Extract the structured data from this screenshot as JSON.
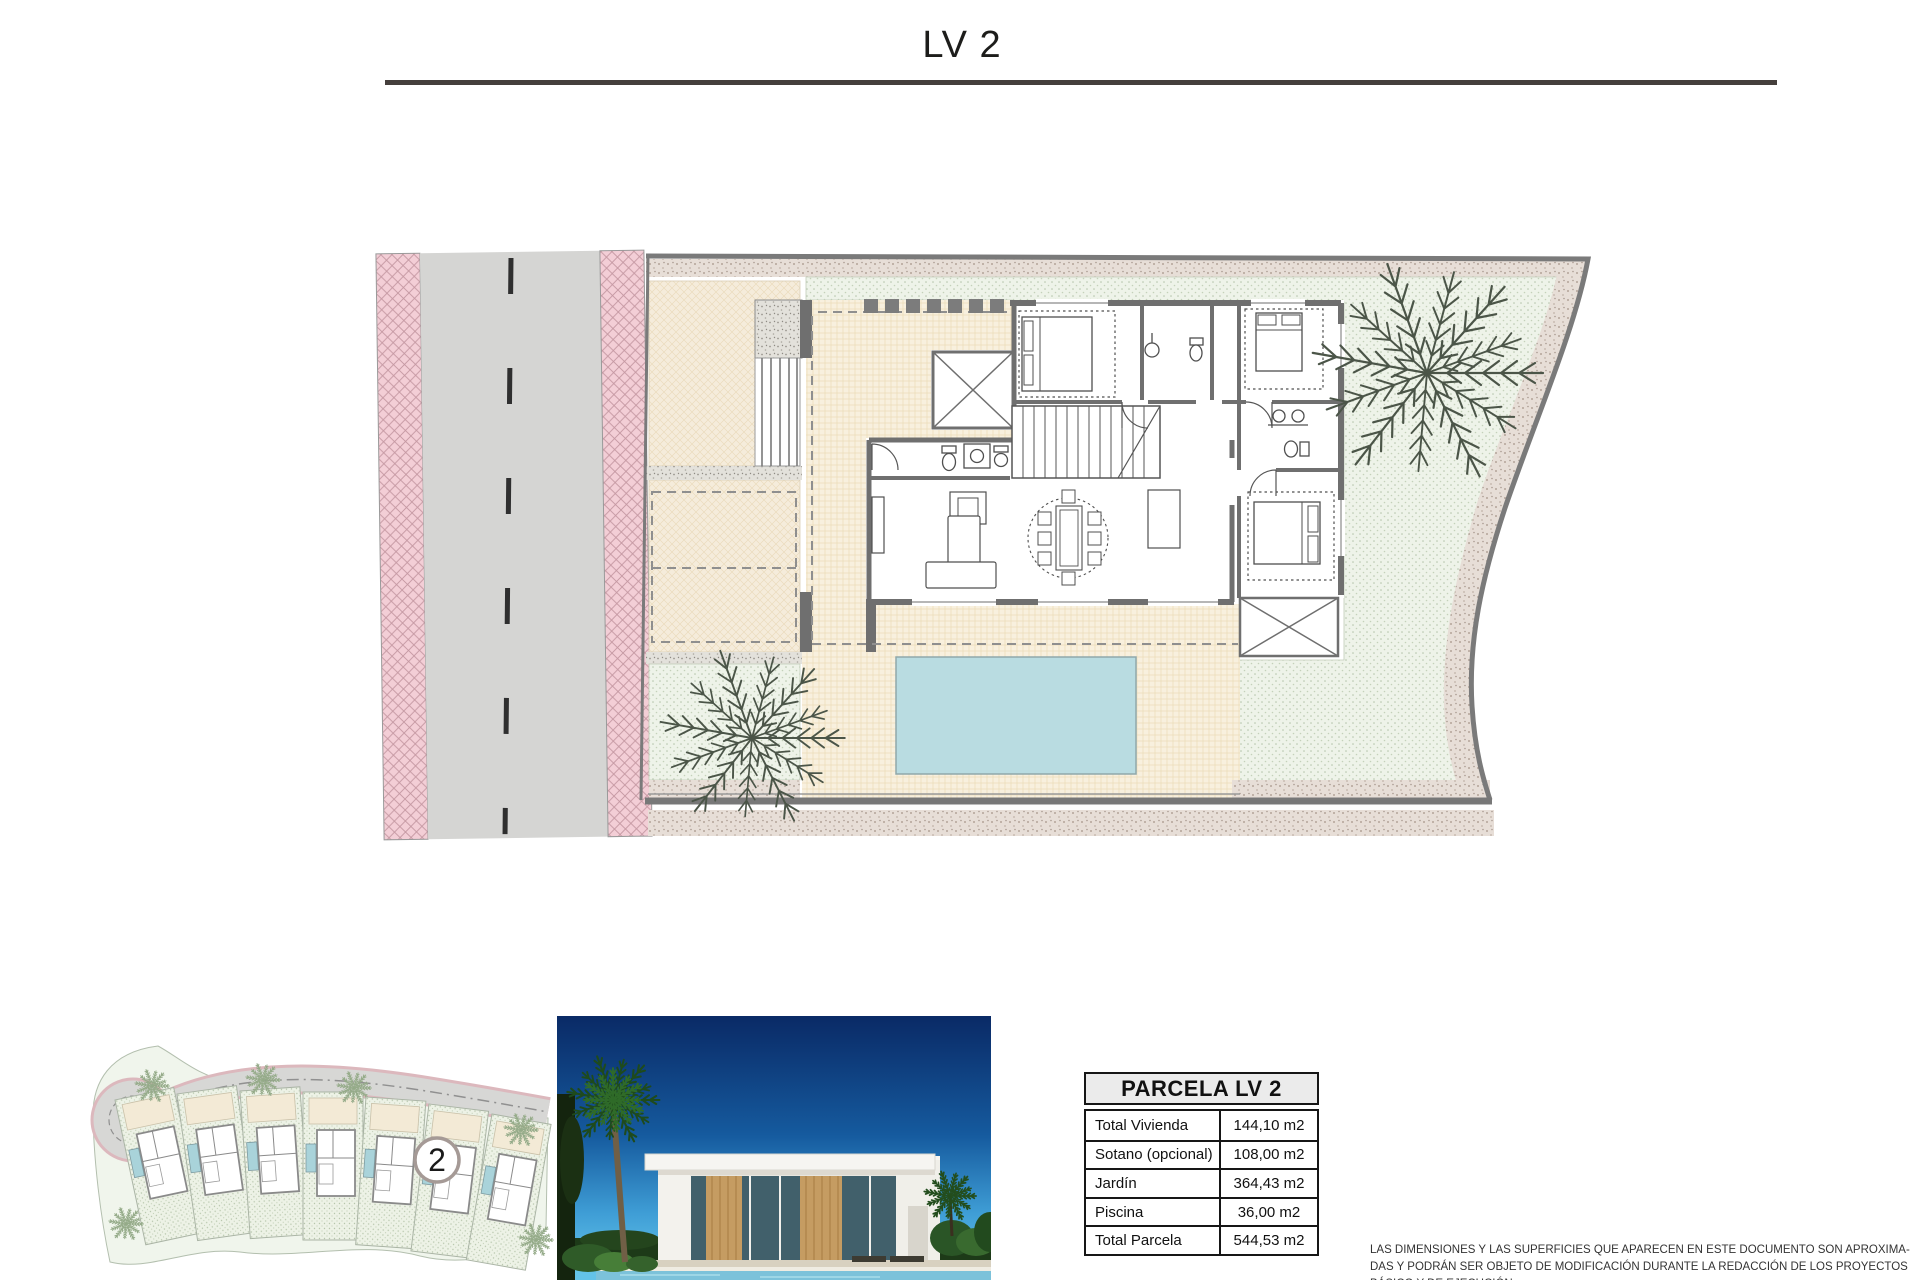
{
  "page": {
    "title": "LV 2"
  },
  "table": {
    "header": "PARCELA LV 2",
    "rows": [
      {
        "label": "Total Vivienda",
        "value": "144,10 m2"
      },
      {
        "label": "Sotano (opcional)",
        "value": "108,00 m2"
      },
      {
        "label": "Jardín",
        "value": "364,43 m2"
      },
      {
        "label": "Piscina",
        "value": "36,00 m2"
      },
      {
        "label": "Total Parcela",
        "value": "544,53 m2"
      }
    ]
  },
  "disclaimer": {
    "lines": [
      "LAS DIMENSIONES Y LAS SUPERFICIES QUE APARECEN EN ESTE DOCUMENTO SON APROXIMA-",
      "DAS Y PODRÁN SER OBJETO DE MODIFICACIÓN DURANTE LA REDACCIÓN DE LOS PROYECTOS",
      "BÁSICO Y DE EJECUCIÓN"
    ]
  },
  "minimap": {
    "badge": "2"
  },
  "colors": {
    "pool": "#b9dce1",
    "sidewalk_pink": "#f3ced6",
    "asphalt": "#d5d5d3",
    "garden_green": "#eef3e9",
    "terrace_beige": "#f8f0de",
    "wall_gray": "#6f6f6f",
    "sky_top": "#0a2a66",
    "sky_bottom": "#63c3e8"
  }
}
